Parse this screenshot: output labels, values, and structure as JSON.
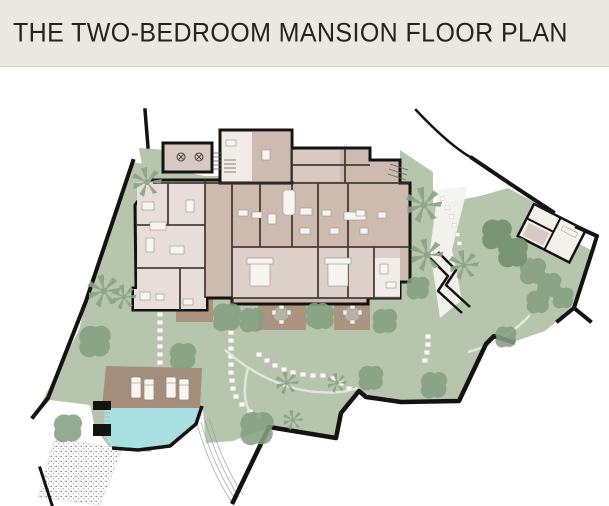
{
  "header": {
    "title": "THE TWO-BEDROOM MANSION FLOOR PLAN"
  },
  "plan": {
    "type": "site-plan",
    "features": [
      "property-boundary-wall",
      "main-villa-building",
      "garage-room",
      "entry-tower",
      "bedroom-wing",
      "green-lawn",
      "garden-trees",
      "palm-trees",
      "swimming-pool",
      "pool-deck",
      "sun-loungers",
      "dining-terraces",
      "stepping-stone-paths",
      "beach-area",
      "garden-outbuilding",
      "garden-steps"
    ]
  },
  "palette": {
    "header_bg": "#ebe8e1",
    "header_text": "#24231f",
    "divider": "#d8d4cb",
    "canvas": "#ffffff",
    "lawn": "#b5c6ad",
    "tree": "#85a081",
    "tree_dark": "#74906e",
    "palm": "#8ba387",
    "wall": "#151311",
    "building_base": "#cdbbaf",
    "room_light": "#e7ddd9",
    "room_mid": "#ddcfc9",
    "room_white": "#f1ece8",
    "room_beige": "#d8c9c2",
    "deck": "#a28e7a",
    "terrace": "#ab957f",
    "pool": "#a8dfe0",
    "furniture": "#f7f5f0",
    "furniture_edge": "#97938c",
    "stone": "#fbfaf6",
    "stipple": "#5c5c5c",
    "path_line": "#e9ebe1",
    "table": "#b7b3a4"
  }
}
